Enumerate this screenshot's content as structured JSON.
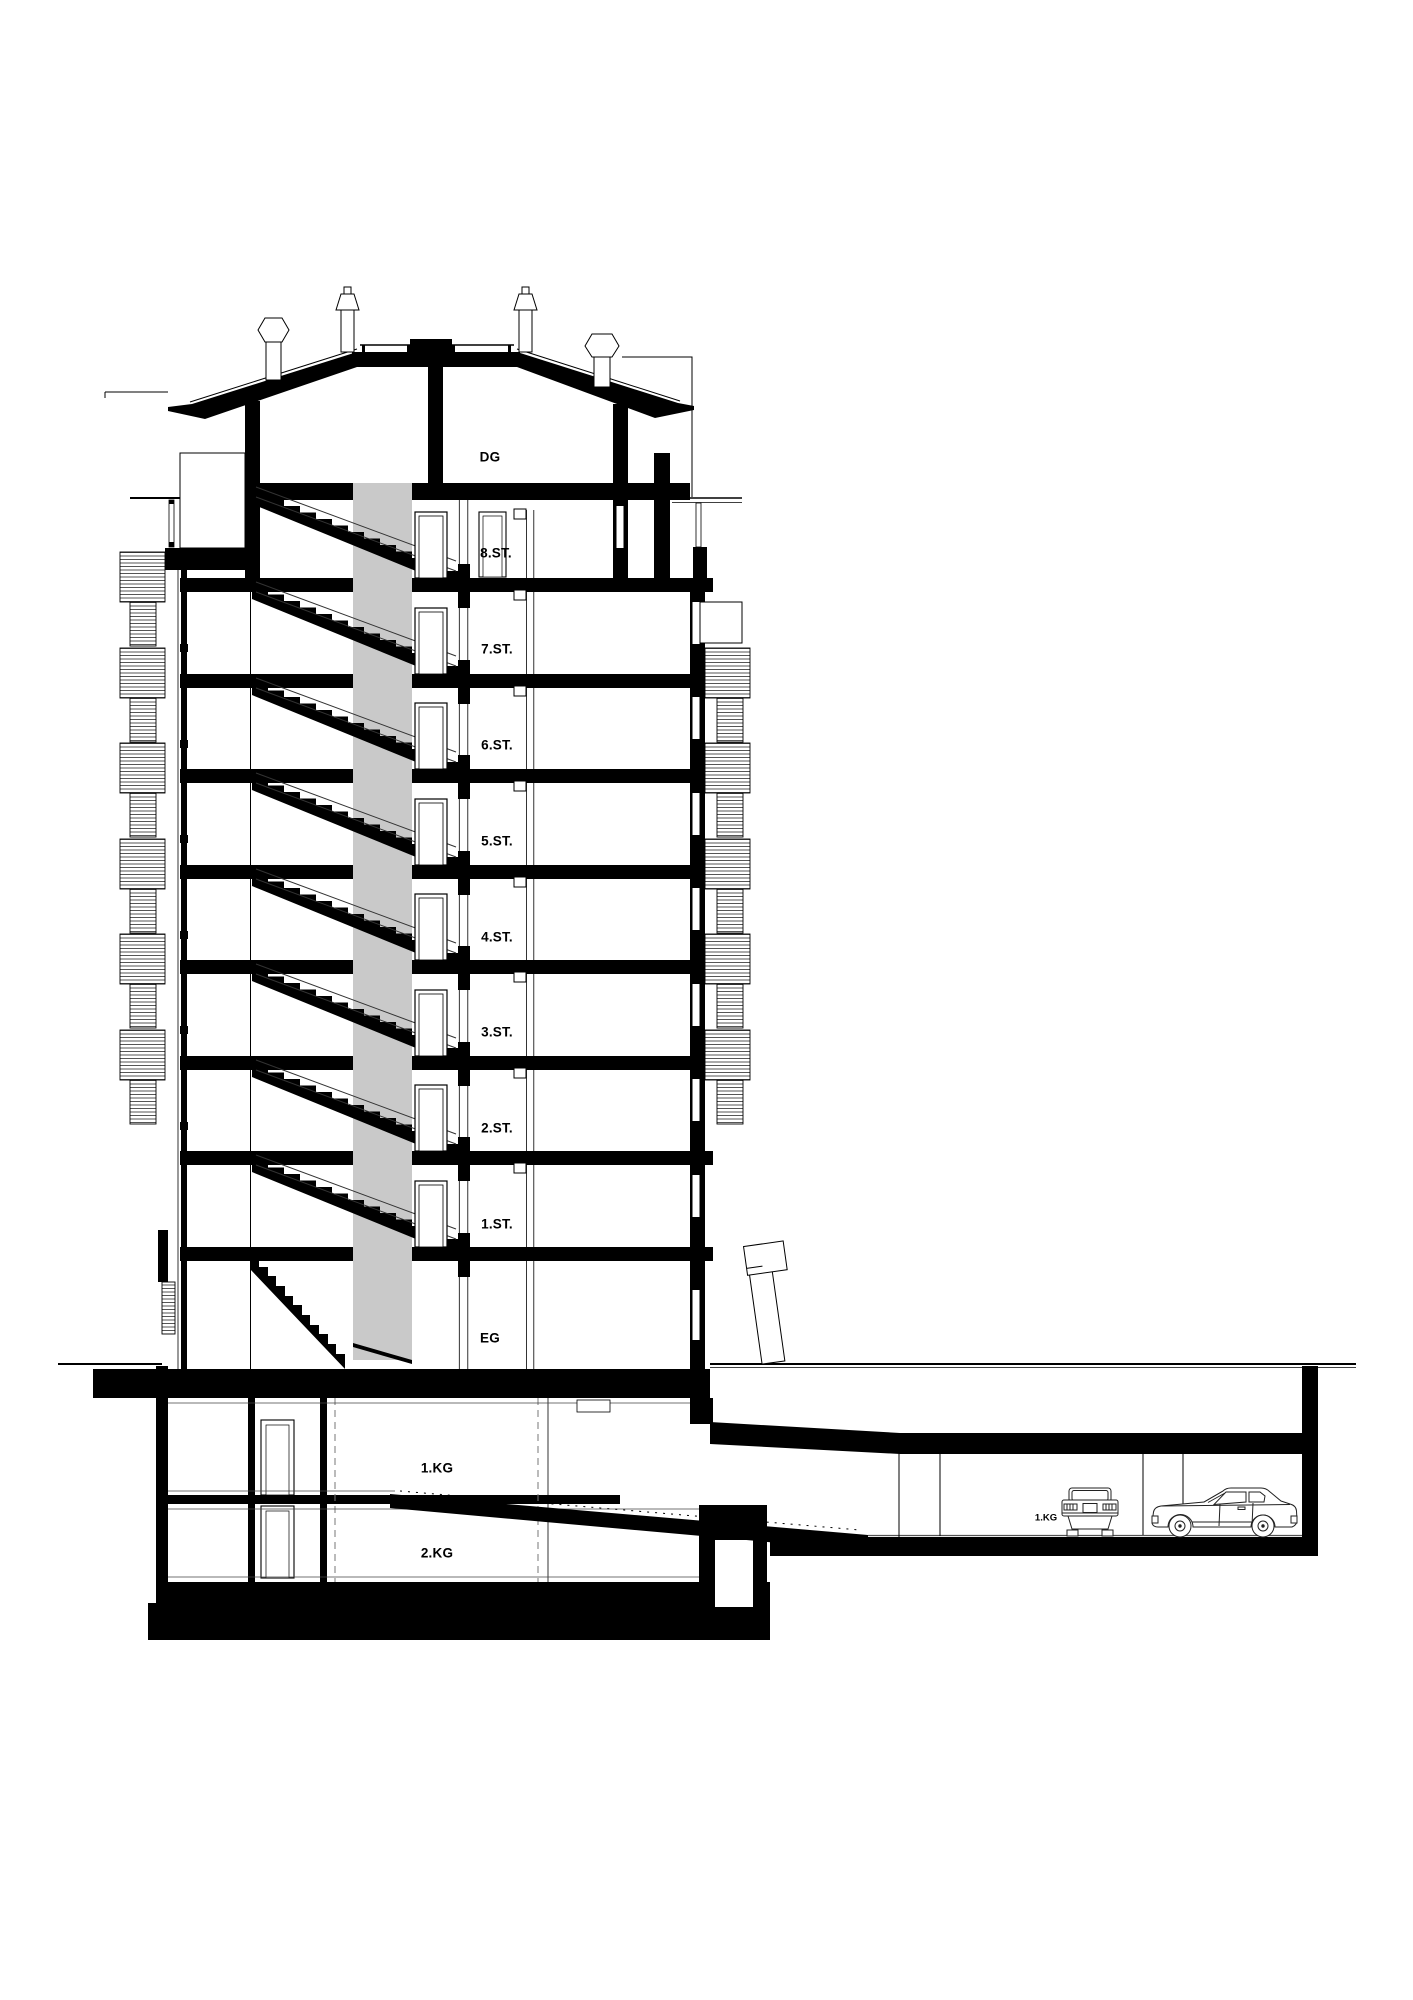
{
  "drawing": {
    "type": "architectural cross-section",
    "floor_labels": [
      {
        "label": "DG",
        "x": 490,
        "y": 457
      },
      {
        "label": "8.ST.",
        "x": 496,
        "y": 553
      },
      {
        "label": "7.ST.",
        "x": 497,
        "y": 649
      },
      {
        "label": "6.ST.",
        "x": 497,
        "y": 745
      },
      {
        "label": "5.ST.",
        "x": 497,
        "y": 841
      },
      {
        "label": "4.ST.",
        "x": 497,
        "y": 937
      },
      {
        "label": "3.ST.",
        "x": 497,
        "y": 1032
      },
      {
        "label": "2.ST.",
        "x": 497,
        "y": 1128
      },
      {
        "label": "1.ST.",
        "x": 497,
        "y": 1224
      },
      {
        "label": "EG",
        "x": 490,
        "y": 1338
      },
      {
        "label": "1.KG",
        "x": 437,
        "y": 1468
      },
      {
        "label": "2.KG",
        "x": 437,
        "y": 1553
      }
    ],
    "garage_label": {
      "label": "1.KG",
      "x": 1046,
      "y": 1518
    },
    "colors": {
      "ink": "#000000",
      "shaft_gray": "#c9c9c9",
      "detail_line": "#444444",
      "background": "#ffffff"
    }
  }
}
